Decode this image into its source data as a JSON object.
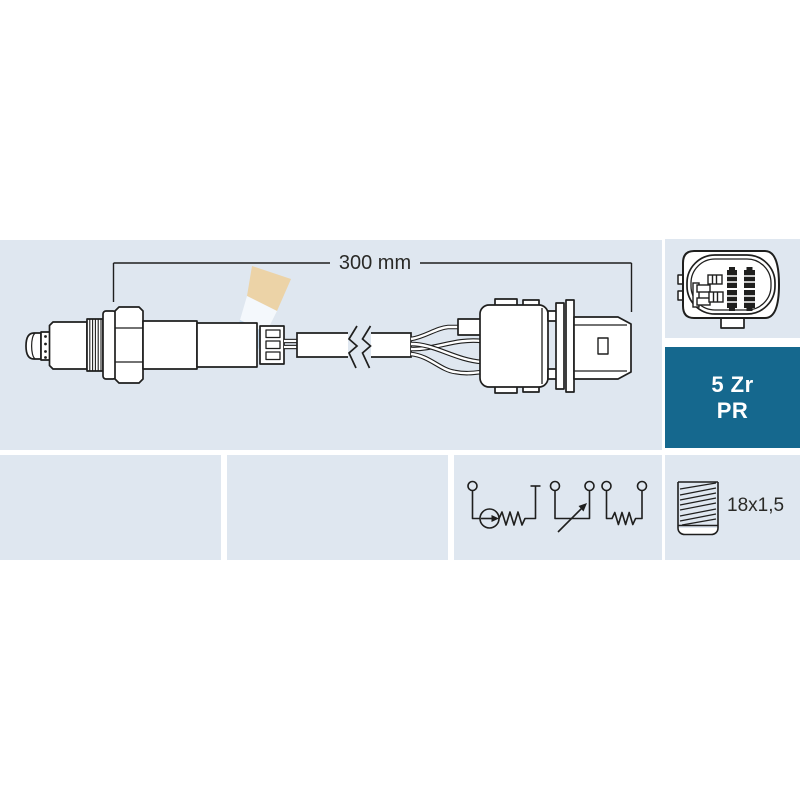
{
  "diagram": {
    "watermark_text": "FAE",
    "dimension_label": "300 mm"
  },
  "spec_badge": {
    "line1": "5 Zr",
    "line2": "PR"
  },
  "thread": {
    "label": "18x1,5"
  },
  "colors": {
    "panel_bg": "#dfe7f0",
    "badge_bg": "#15688e",
    "badge_text": "#ffffff",
    "line": "#1f1f1e",
    "text": "#2a2a27",
    "watermark_tan": "#ecd2a2",
    "watermark_blue": "#c2daee",
    "watermark_white": "#f6fafd"
  }
}
